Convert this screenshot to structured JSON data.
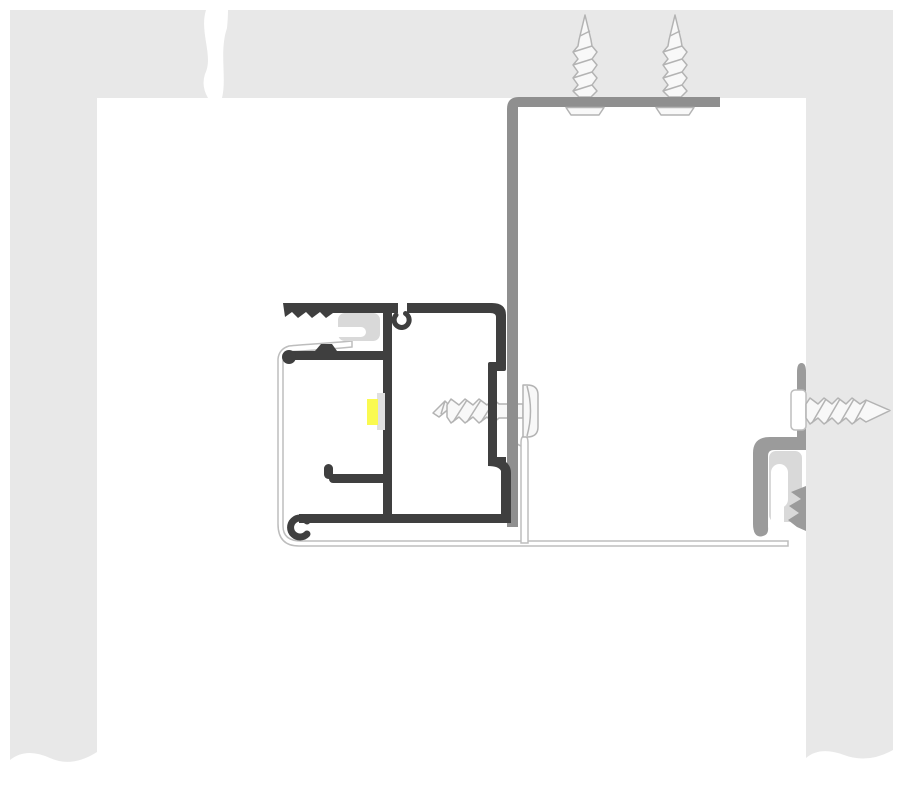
{
  "diagram": {
    "type": "technical-cross-section",
    "subject": "aluminum-profile-mounting-detail",
    "colors": {
      "background": "#ffffff",
      "wall": "#e8e8e8",
      "bracket": "#8f8f8f",
      "profile": "#3f3f3f",
      "gasket": "#d9d9d9",
      "clip": "#9b9b9b",
      "led": "#fafa50",
      "diffuser": "#e0e0e0",
      "screw_outline": "#b3b3b3",
      "screw_fill": "#f8f8f8",
      "flashing_outline": "#bdbdbd"
    },
    "components": [
      "ceiling-wall-structure-with-break-line",
      "left-wall-column",
      "right-wall-column",
      "L-shaped-mounting-bracket",
      "two-vertical-fixing-screws",
      "horizontal-fixing-screw-center",
      "horizontal-fixing-screw-right",
      "main-aluminium-profile-section",
      "led-strip-with-diffuser",
      "rubber-gaskets",
      "sill-flashing-sheet",
      "snap-in-clip-profile-right"
    ]
  }
}
